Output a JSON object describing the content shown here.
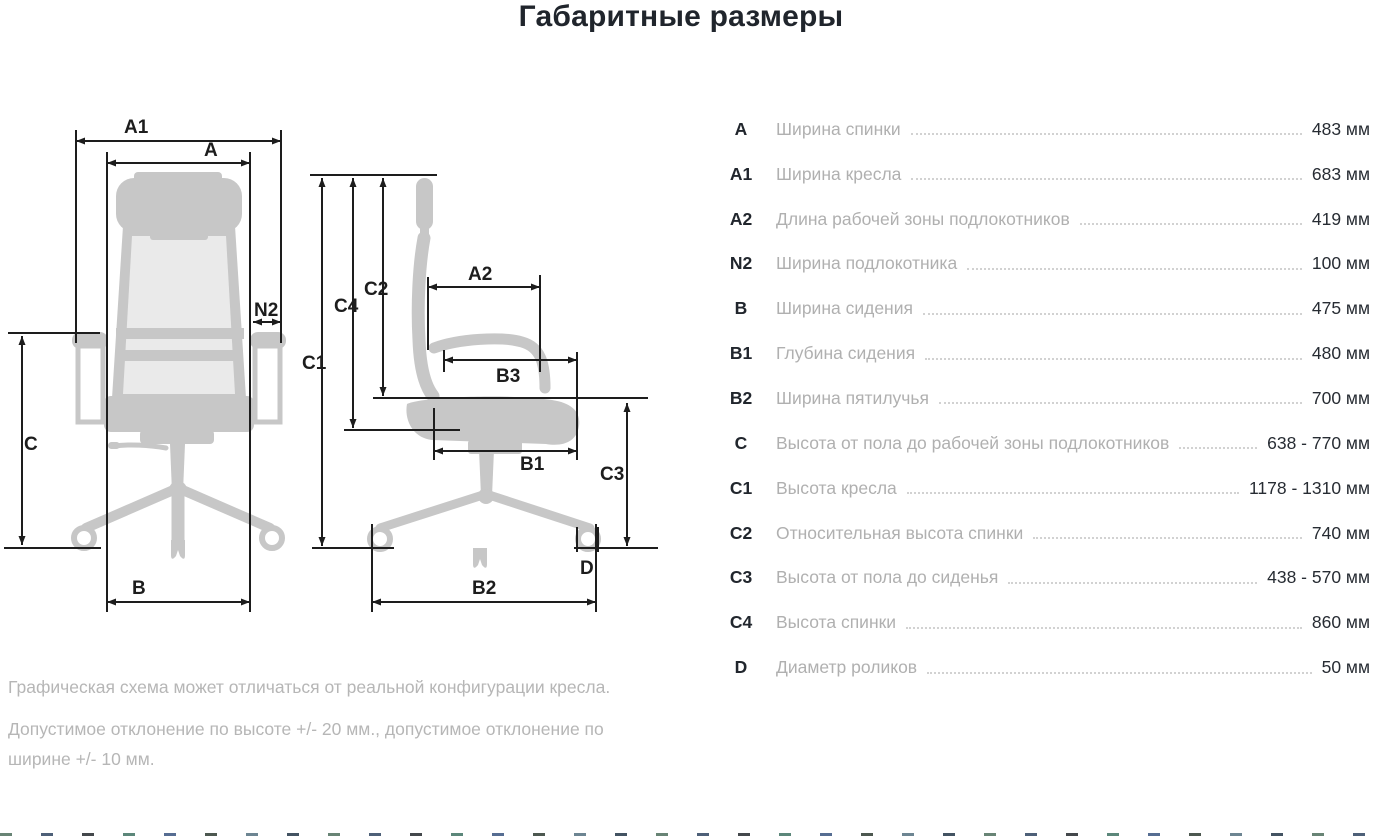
{
  "title": "Габаритные размеры",
  "diagram": {
    "labels": {
      "a1": "A1",
      "a": "A",
      "n2": "N2",
      "c": "C",
      "b": "B",
      "c1": "C1",
      "c4": "C4",
      "c2": "C2",
      "a2": "A2",
      "b3": "B3",
      "b1": "B1",
      "c3": "C3",
      "d": "D",
      "b2": "B2"
    }
  },
  "table": {
    "rows": [
      {
        "code": "A",
        "label": "Ширина спинки",
        "value": "483 мм"
      },
      {
        "code": "A1",
        "label": "Ширина кресла",
        "value": "683 мм"
      },
      {
        "code": "A2",
        "label": "Длина рабочей зоны подлокотников",
        "value": "419 мм"
      },
      {
        "code": "N2",
        "label": "Ширина подлокотника",
        "value": "100 мм"
      },
      {
        "code": "B",
        "label": "Ширина сидения",
        "value": "475 мм"
      },
      {
        "code": "B1",
        "label": "Глубина сидения",
        "value": "480 мм"
      },
      {
        "code": "B2",
        "label": "Ширина пятилучья",
        "value": "700 мм"
      },
      {
        "code": "C",
        "label": "Высота от пола до рабочей зоны подлокотников",
        "value": "638 - 770 мм"
      },
      {
        "code": "C1",
        "label": "Высота кресла",
        "value": "1178 - 1310 мм"
      },
      {
        "code": "C2",
        "label": "Относительная высота спинки",
        "value": "740 мм"
      },
      {
        "code": "C3",
        "label": "Высота от пола до сиденья",
        "value": "438 - 570 мм"
      },
      {
        "code": "C4",
        "label": "Высота спинки",
        "value": "860 мм"
      },
      {
        "code": "D",
        "label": "Диаметр роликов",
        "value": "50 мм"
      }
    ]
  },
  "notes": {
    "note1": "Графическая схема может отличаться от реальной конфигурации кресла.",
    "note2": "Допустимое отклонение по высоте +/- 20 мм., допустимое отклонение по ширине +/- 10 мм."
  },
  "colors": {
    "text_dark": "#21262d",
    "text_muted": "#b0b0b0",
    "chair_gray": "#c7c7c7",
    "chair_mesh": "#eaeaea",
    "dim_line": "#1d1d1d"
  },
  "footer_ticks": {
    "count": 34,
    "colors": [
      "#4e6e5d",
      "#2f4460",
      "#23282d",
      "#3f7263",
      "#38537f",
      "#2e3b31",
      "#54707f",
      "#223547"
    ]
  }
}
